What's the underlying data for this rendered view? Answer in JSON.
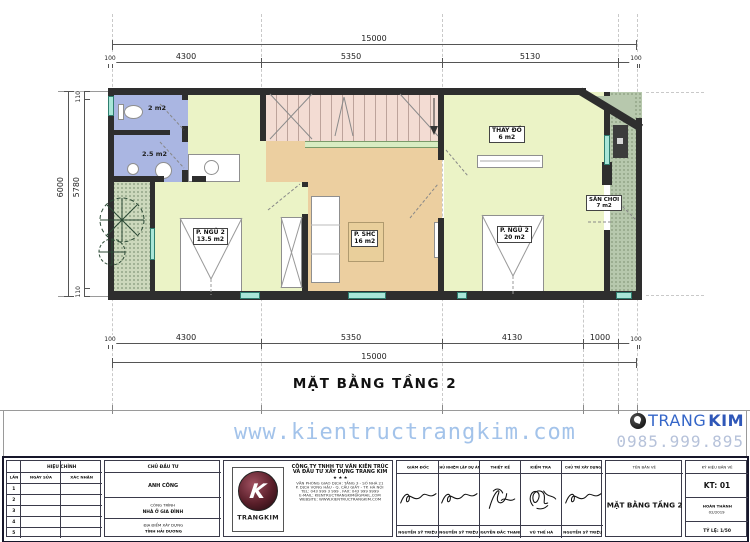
{
  "plan": {
    "title": "MẶT BẰNG TẦNG 2",
    "rooms": {
      "wc1": {
        "area": "2 m2"
      },
      "wc2": {
        "area": "2.5 m2"
      },
      "bedroom1": {
        "name": "P. NGỦ 2",
        "area": "13.5 m2"
      },
      "shc": {
        "name": "P. SHC",
        "area": "16 m2"
      },
      "bedroom2": {
        "name": "P. NGỦ 2",
        "area": "20 m2"
      },
      "thaydo": {
        "name": "THAY ĐỒ",
        "area": "6 m2"
      },
      "sanchoi": {
        "name": "SÂN CHƠI",
        "area": "7 m2"
      }
    },
    "dims": {
      "top_overall": "15000",
      "top_segments": [
        "4300",
        "5350",
        "5130"
      ],
      "bottom_segments": [
        "4300",
        "5350",
        "4130",
        "1000"
      ],
      "bottom_overall": "15000",
      "end_small": "100",
      "left_outer": "6000",
      "left_inner": "5780",
      "left_small": "110"
    }
  },
  "watermark": {
    "url": "www.kientructrangkim.com",
    "phone": "0985.999.895",
    "brand_trang": "TRANG",
    "brand_kim": "KIM"
  },
  "titleblock": {
    "revision": {
      "header": "HIỆU CHỈNH",
      "col_lan": "LẦN",
      "col_ngay": "NGÀY SỬA",
      "col_xacnhan": "XÁC NHẬN",
      "rows": [
        "1",
        "2",
        "3",
        "4",
        "5"
      ]
    },
    "investor": {
      "header": "CHỦ ĐẦU TƯ",
      "name": "ANH CÔNG",
      "project_label": "CÔNG TRÌNH",
      "project_name": "NHÀ Ở GIA ĐÌNH",
      "location_label": "ĐỊA ĐIỂM XÂY DỰNG",
      "location_name": "TỈNH HẢI DƯƠNG"
    },
    "company": {
      "brand": "TRANGKIM",
      "logo_letter": "K",
      "name1": "CÔNG TY TNHH TƯ VẤN KIẾN TRÚC",
      "name2": "VÀ ĐẦU TƯ XÂY DỰNG TRANG KIM",
      "stars": "★    ★    ★",
      "line1": "VĂN PHÒNG GIAO DỊCH: TẦNG 3 - SỐ NHÀ 21",
      "line2": "P. DỊCH VỌNG HẬU - Q. CẦU GIẤY - TP. HÀ NỘI",
      "line3": "TEL: 043 999 3 999 . FAX: 043 999 9999",
      "line4": "E-MAIL: KIENTRUCTRANGKIM@GMAIL.COM",
      "line5": "WEBSITE: WWW.KIENTRUCTRANGKIM.COM"
    },
    "signatures": [
      {
        "role": "GIÁM ĐỐC",
        "name": "NGUYỄN SỸ TRIỆU"
      },
      {
        "role": "CHỦ NHIỆM LẬP DỰ ÁN",
        "name": "NGUYỄN SỸ TRIỆU"
      },
      {
        "role": "THIẾT KẾ",
        "name": "NGUYỄN ĐẮC THẠNH"
      },
      {
        "role": "KIỂM TRA",
        "name": "VŨ THẾ HÀ"
      },
      {
        "role": "CHỦ TRÌ XÂY DỰNG",
        "name": "NGUYỄN SỸ TRIỆU"
      }
    ],
    "drawing": {
      "header": "TÊN BẢN VẼ",
      "name": "MẶT BẰNG TẦNG 2"
    },
    "meta": {
      "header": "KÝ HIỆU BẢN VẼ",
      "code": "KT: 01",
      "status": "HOÀN THÀNH",
      "date": "02/2019",
      "scale": "TỶ LỆ: 1/50"
    }
  }
}
